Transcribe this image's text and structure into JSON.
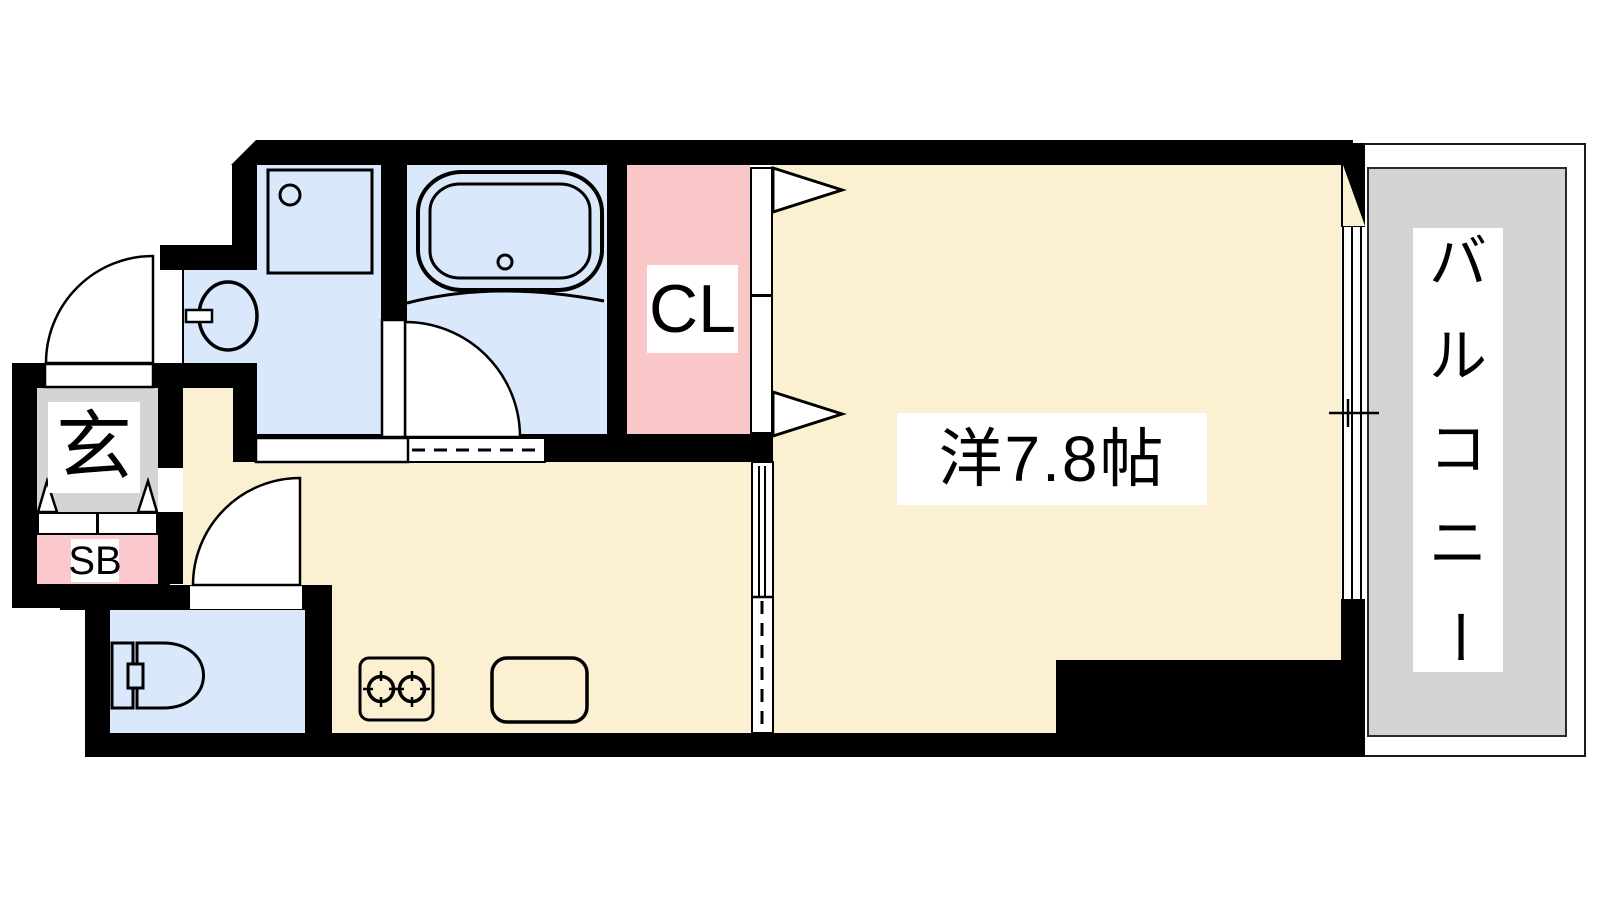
{
  "floorplan": {
    "rooms": {
      "western_room": {
        "label": "洋7.8帖"
      },
      "closet": {
        "label": "CL"
      },
      "balcony": {
        "label": "バルコニー",
        "label_chars": [
          "バ",
          "ル",
          "コ",
          "ニ",
          "ー"
        ]
      },
      "entrance": {
        "label": "玄"
      },
      "shoe_box": {
        "label": "SB"
      }
    },
    "colors": {
      "room_fill": "#fbf0d2",
      "wet_area_fill": "#d9e8fa",
      "closet_fill": "#f9c7c7",
      "shoe_box_fill": "#fbc9cd",
      "kitchen_counter_fill": "#e6def0",
      "balcony_fill": "#d3d3d3",
      "entrance_fill": "#d4d4d4",
      "wall": "#000000"
    }
  }
}
